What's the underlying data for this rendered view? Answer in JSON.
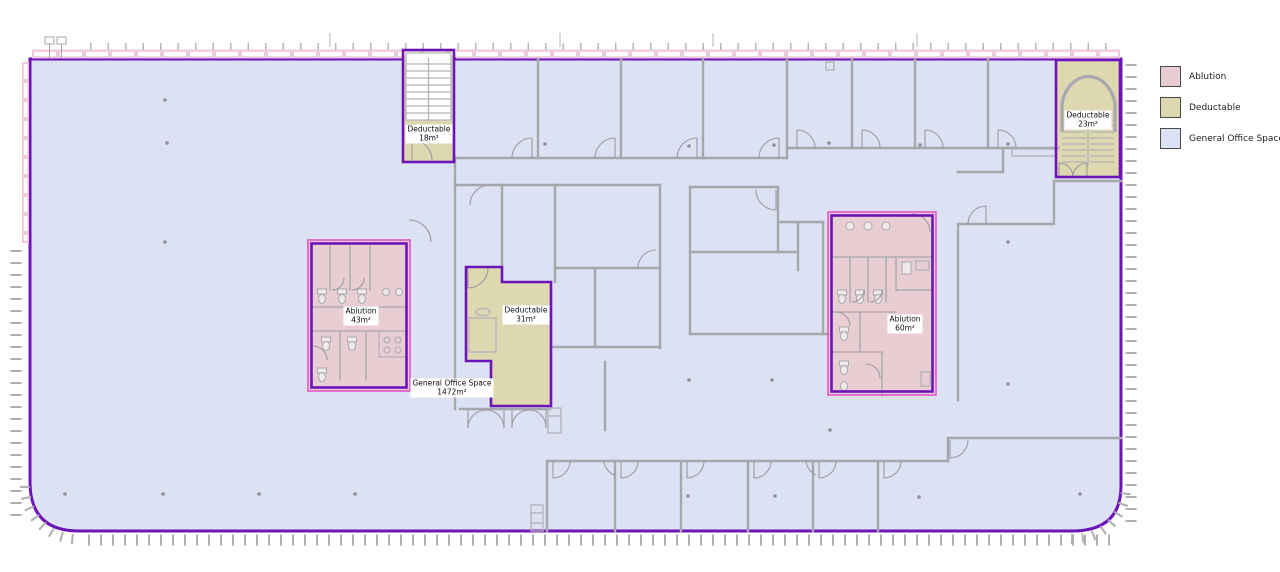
{
  "legend": {
    "items": [
      {
        "label": "Ablution",
        "color": "#e8cdd2"
      },
      {
        "label": "Deductable",
        "color": "#ddd8b0"
      },
      {
        "label": "General Office Space",
        "color": "#dce2f4"
      }
    ]
  },
  "zones": [
    {
      "name": "Deductable",
      "area": "18m²",
      "type": "deductable"
    },
    {
      "name": "Deductable",
      "area": "23m²",
      "type": "deductable"
    },
    {
      "name": "Ablution",
      "area": "43m²",
      "type": "ablution"
    },
    {
      "name": "Deductable",
      "area": "31m²",
      "type": "deductable"
    },
    {
      "name": "Ablution",
      "area": "60m²",
      "type": "ablution"
    },
    {
      "name": "General Office Space",
      "area": "1472m²",
      "type": "general-office"
    }
  ],
  "colors": {
    "ablution": "#e8cdd2",
    "deductable": "#ddd8b0",
    "general_office": "#dce2f4",
    "zone_border_purple": "#6d14b8",
    "zone_border_magenta": "#e554c8",
    "wall_gray": "#a6a6ab",
    "facade_pink": "#edc9de"
  }
}
